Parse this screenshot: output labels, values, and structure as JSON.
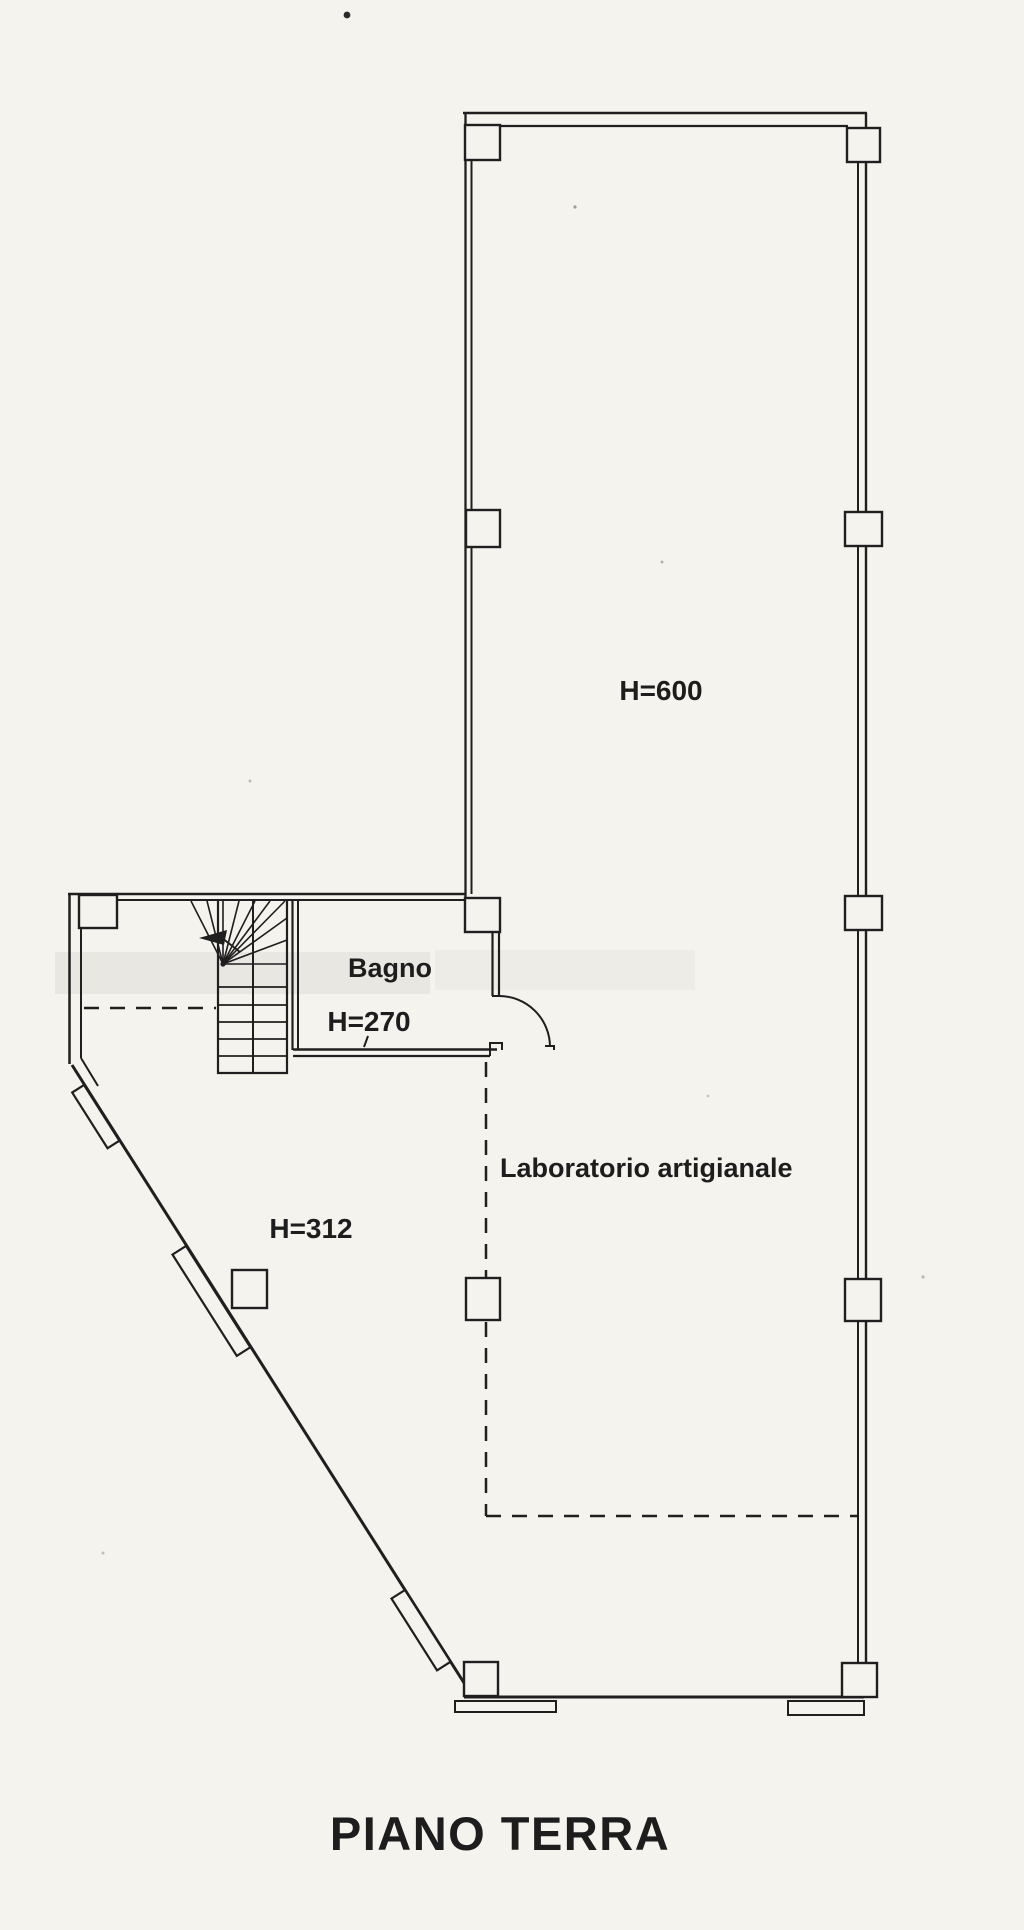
{
  "colors": {
    "paper": "#f5f3ed",
    "ink": "#1f1f1f",
    "scan_smudge": "#9a9a98"
  },
  "plan": {
    "floor_title": "PIANO TERRA",
    "rooms": [
      {
        "id": "main-room",
        "height_label": "H=600"
      },
      {
        "id": "bagno",
        "name_label": "Bagno",
        "height_label": "H=270"
      },
      {
        "id": "laboratorio",
        "name_label": "Laboratorio artigianale",
        "height_label": "H=312"
      }
    ]
  }
}
